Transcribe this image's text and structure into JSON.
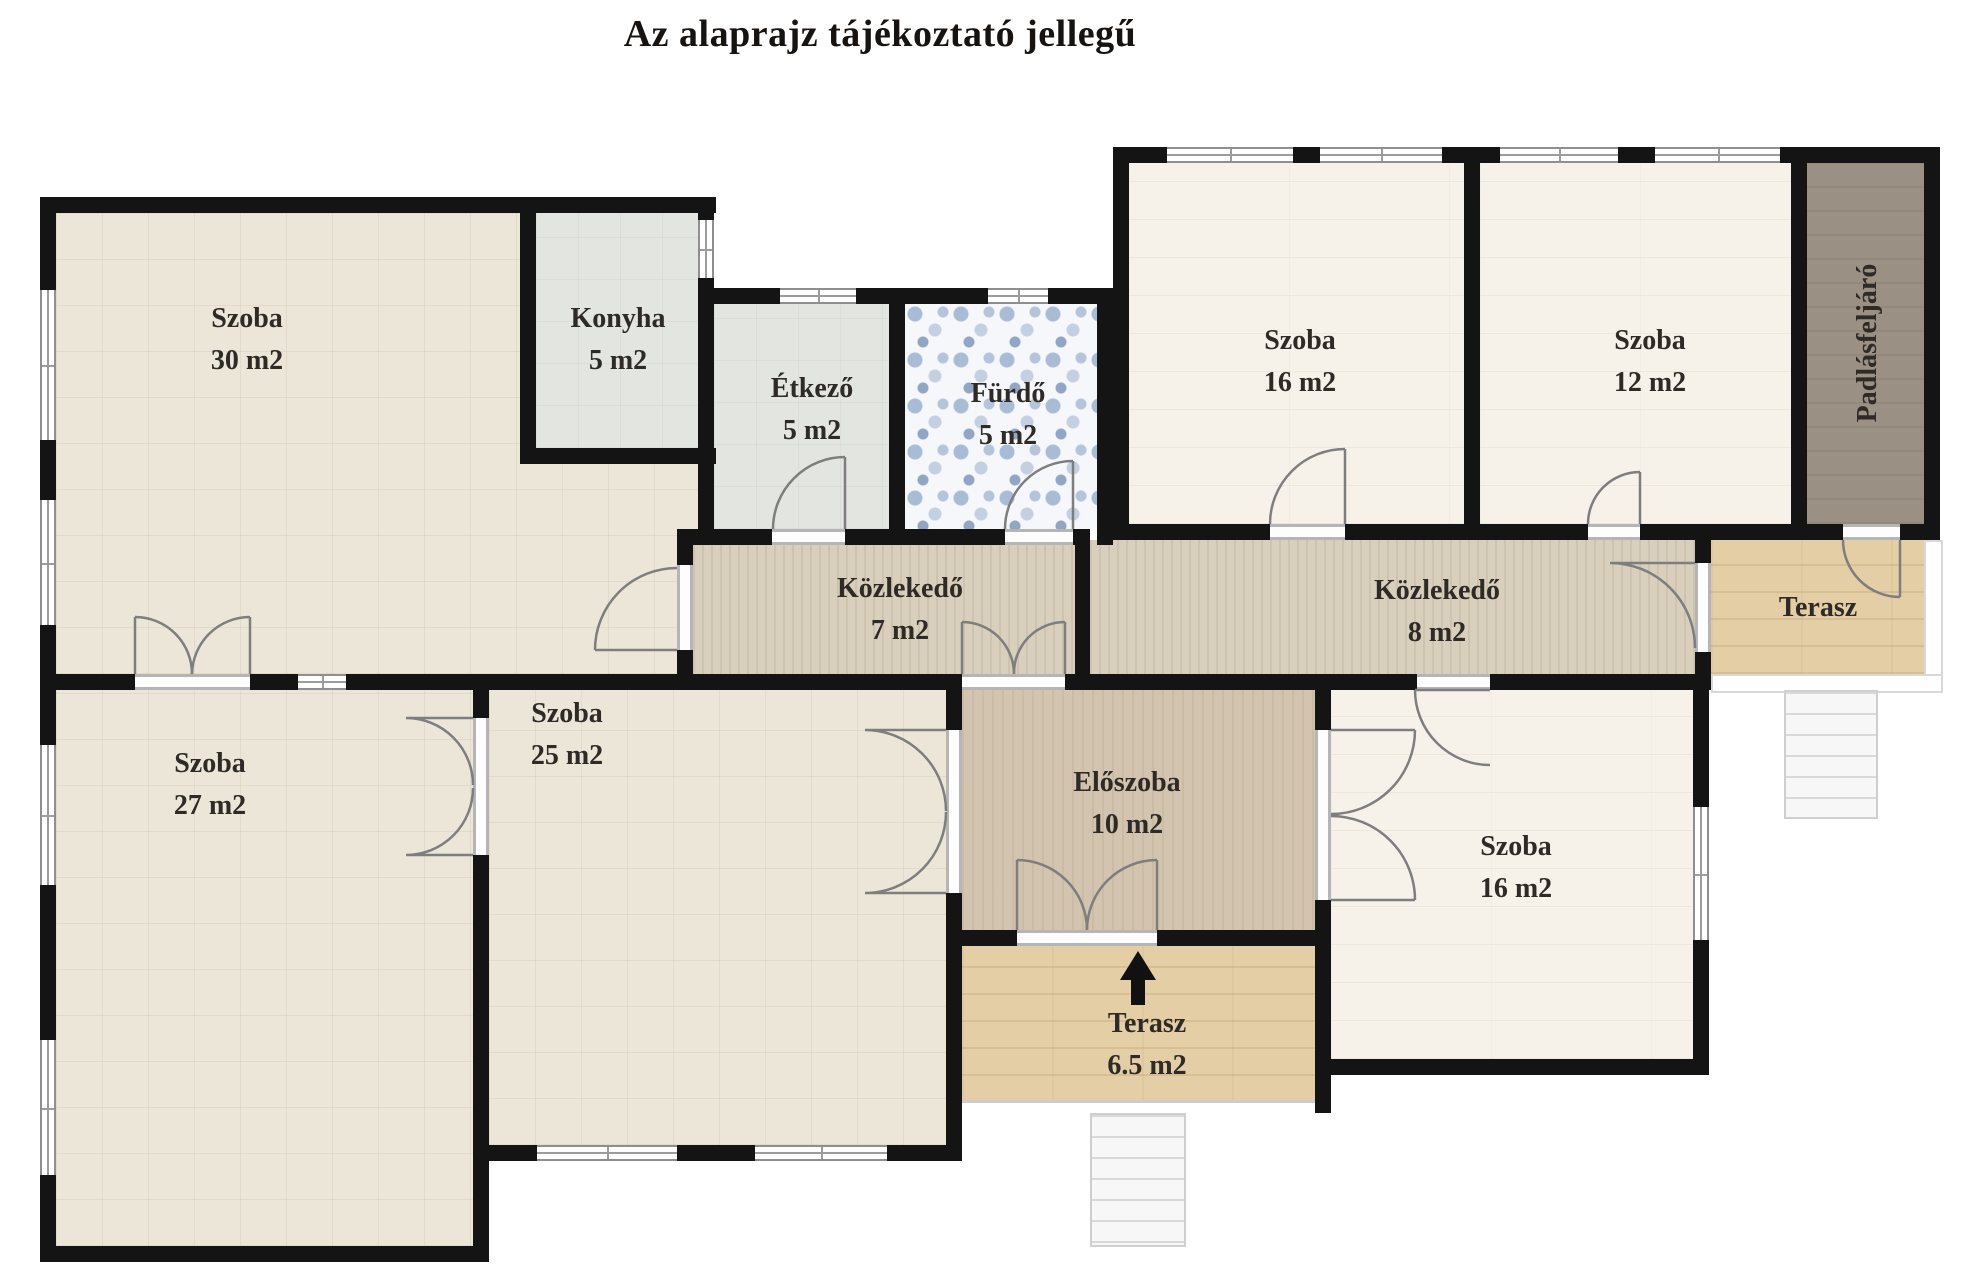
{
  "title": "Az alaprajz tájékoztató jellegű",
  "rooms": {
    "szoba30": {
      "name": "Szoba",
      "area": "30 m2"
    },
    "konyha": {
      "name": "Konyha",
      "area": "5 m2"
    },
    "etkezo": {
      "name": "Étkező",
      "area": "5 m2"
    },
    "furdo": {
      "name": "Fürdő",
      "area": "5 m2"
    },
    "szoba16_felso": {
      "name": "Szoba",
      "area": "16 m2"
    },
    "szoba12": {
      "name": "Szoba",
      "area": "12 m2"
    },
    "padlasfeljaro": {
      "name": "Padlásfeljáró"
    },
    "kozlekedo7": {
      "name": "Közlekedő",
      "area": "7 m2"
    },
    "kozlekedo8": {
      "name": "Közlekedő",
      "area": "8 m2"
    },
    "terasz_felso": {
      "name": "Terasz"
    },
    "szoba27": {
      "name": "Szoba",
      "area": "27 m2"
    },
    "szoba25": {
      "name": "Szoba",
      "area": "25 m2"
    },
    "eloszoba": {
      "name": "Előszoba",
      "area": "10 m2"
    },
    "szoba16_also": {
      "name": "Szoba",
      "area": "16 m2"
    },
    "terasz_also": {
      "name": "Terasz",
      "area": "6.5 m2"
    }
  },
  "colors": {
    "wall": "#141414",
    "floor_beige": "#ece6d9",
    "floor_light": "#f6f2e9",
    "floor_gray": "#e3e5e0",
    "floor_hall": "#d8cfbc",
    "floor_entry": "#d2c4ae",
    "floor_terrace": "#e3cea6",
    "floor_attic": "#9b9084",
    "bath_blue": "#a9bcd6",
    "label_text": "#2e2a26"
  }
}
